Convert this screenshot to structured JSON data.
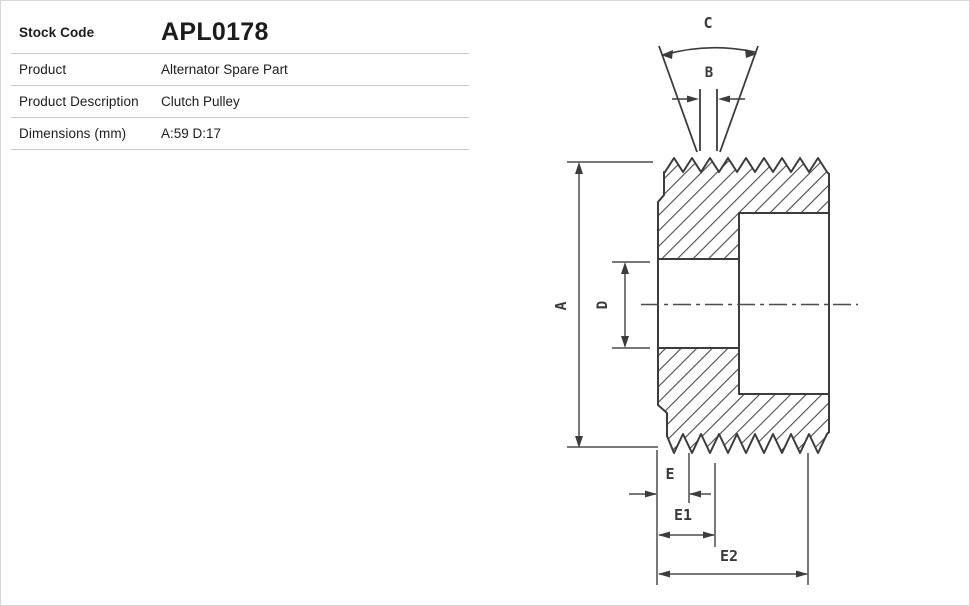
{
  "page": {
    "background": "#ffffff",
    "border_color": "#d8d8d8"
  },
  "spec_table": {
    "rows": [
      {
        "label": "Stock Code",
        "value": "APL0178"
      },
      {
        "label": "Product",
        "value": "Alternator Spare Part"
      },
      {
        "label": "Product Description",
        "value": "Clutch Pulley"
      },
      {
        "label": "Dimensions (mm)",
        "value": "A:59 D:17"
      }
    ]
  },
  "diagram": {
    "description": "Clutch pulley cross-section technical drawing with poly-V ribbed outer surface, stepped bore, V-groove profile symbol and dimension callouts",
    "line_color": "#3c3c3c",
    "labels": {
      "c": "C",
      "b": "B",
      "a": "A",
      "d": "D",
      "e": "E",
      "e1": "E1",
      "e2": "E2"
    }
  }
}
